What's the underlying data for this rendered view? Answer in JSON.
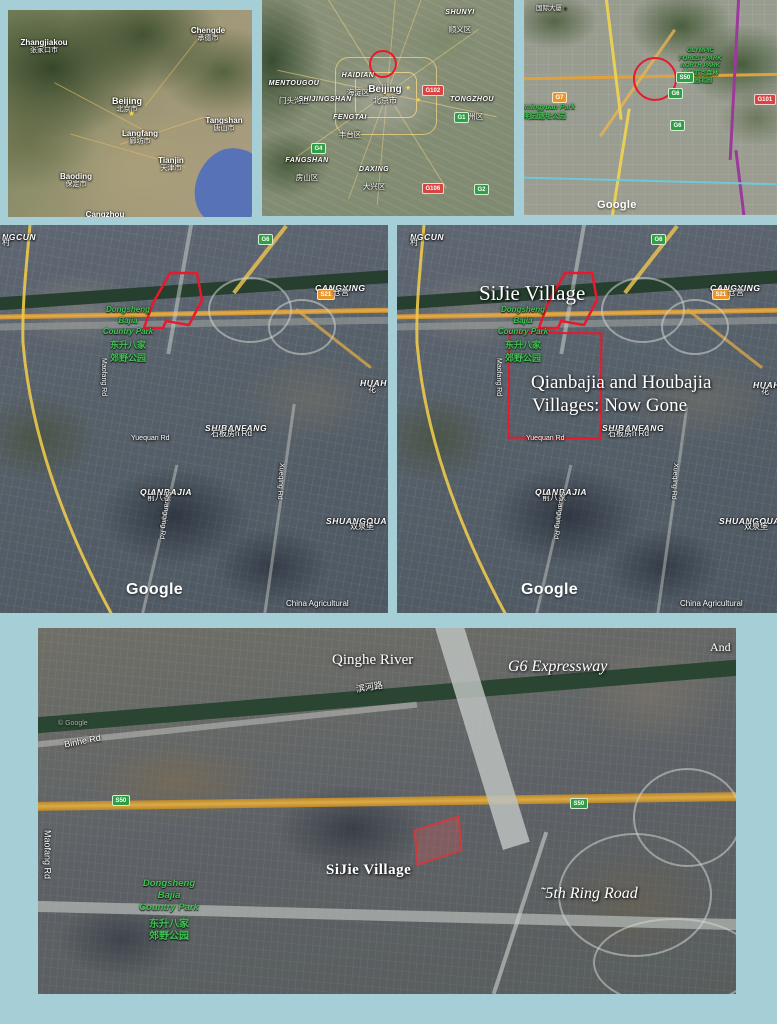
{
  "colors": {
    "background": "#a5ced6",
    "annotation_red": "#e8192c"
  },
  "icons": {
    "star": "★",
    "poi_dot": "●"
  },
  "map1": {
    "cities": [
      {
        "en": "Zhangjiakou",
        "cn": "张家口市"
      },
      {
        "en": "Chengde",
        "cn": "承德市"
      },
      {
        "en": "Beijing",
        "cn": "北京市"
      },
      {
        "en": "Langfang",
        "cn": "廊坊市"
      },
      {
        "en": "Tangshan",
        "cn": "唐山市"
      },
      {
        "en": "Tianjin",
        "cn": "天津市"
      },
      {
        "en": "Baoding",
        "cn": "保定市"
      },
      {
        "en": "Cangzhou",
        "cn": ""
      }
    ]
  },
  "map2": {
    "city": {
      "en": "Beijing",
      "cn": "北京市"
    },
    "districts": [
      {
        "en": "SHUNYI",
        "cn": "顺义区"
      },
      {
        "en": "MENTOUGOU",
        "cn": "门头沟区"
      },
      {
        "en": "HAIDIAN",
        "cn": "海淀区"
      },
      {
        "en": "SHIJINGSHAN",
        "cn": "石景山区"
      },
      {
        "en": "FENGTAI",
        "cn": "丰台区"
      },
      {
        "en": "FANGSHAN",
        "cn": "房山区"
      },
      {
        "en": "DAXING",
        "cn": "大兴区"
      },
      {
        "en": "TONGZHOU",
        "cn": "通州区"
      }
    ],
    "badges": [
      "G102",
      "G1",
      "G4",
      "G106",
      "G2"
    ]
  },
  "map3": {
    "building": "国际大厦",
    "olympic_park": [
      "OLYMPIC",
      "FOREST PARK",
      "NORTH PARK",
      "奥林匹克森林",
      "公园北园"
    ],
    "yuanmingyuan": {
      "en": "Yuanmingyuan Park",
      "cn": "圆明园遗址公园"
    },
    "badges": {
      "s50": "S50",
      "g6": "G6",
      "g7": "G7",
      "g101": "G101"
    },
    "watermark": "Google"
  },
  "sat": {
    "ngcun": "NGCUN",
    "ngcun_cn": "村",
    "g6_badge": "G6",
    "cangying": "CANGYING",
    "cangying_badge": "S21",
    "cangying_cn": "仓营",
    "park": [
      "Dongsheng",
      "Bajia",
      "Country Park",
      "东升八家",
      "郊野公园"
    ],
    "maofang": "Maofang Rd",
    "huah": "HUAH",
    "huah_cn": "花",
    "shibanfang": "SHIBANFANG",
    "shibanfang_cn": "石板房n Rd",
    "yuequan": "Yuequan Rd",
    "qianbajia": "QIANBAJIA",
    "qianbajia_cn": "前八家",
    "shuangqing": "Shuangqing Rd",
    "xueqing": "Xueqing Rd",
    "shuangquan": "SHUANGQUA",
    "shuangquan_cn": "双泉堡",
    "watermark": "Google",
    "china_agricultural": "China Agricultural"
  },
  "annotations": {
    "sijie": "SiJie Village",
    "gone1": "Qianbajia and Houbajia",
    "gone2": "Villages: Now Gone"
  },
  "map6": {
    "qinghe": "Qinghe River",
    "g6_expressway": "G6 Expressway",
    "and_label": "And",
    "binhe_cn": "滨河路",
    "binhe": "Binhe Rd",
    "s50": "S50",
    "maofang": "Maofang Rd",
    "sijie": "SiJie Village",
    "ring": "˜5th Ring Road",
    "copyright": "© Google"
  }
}
